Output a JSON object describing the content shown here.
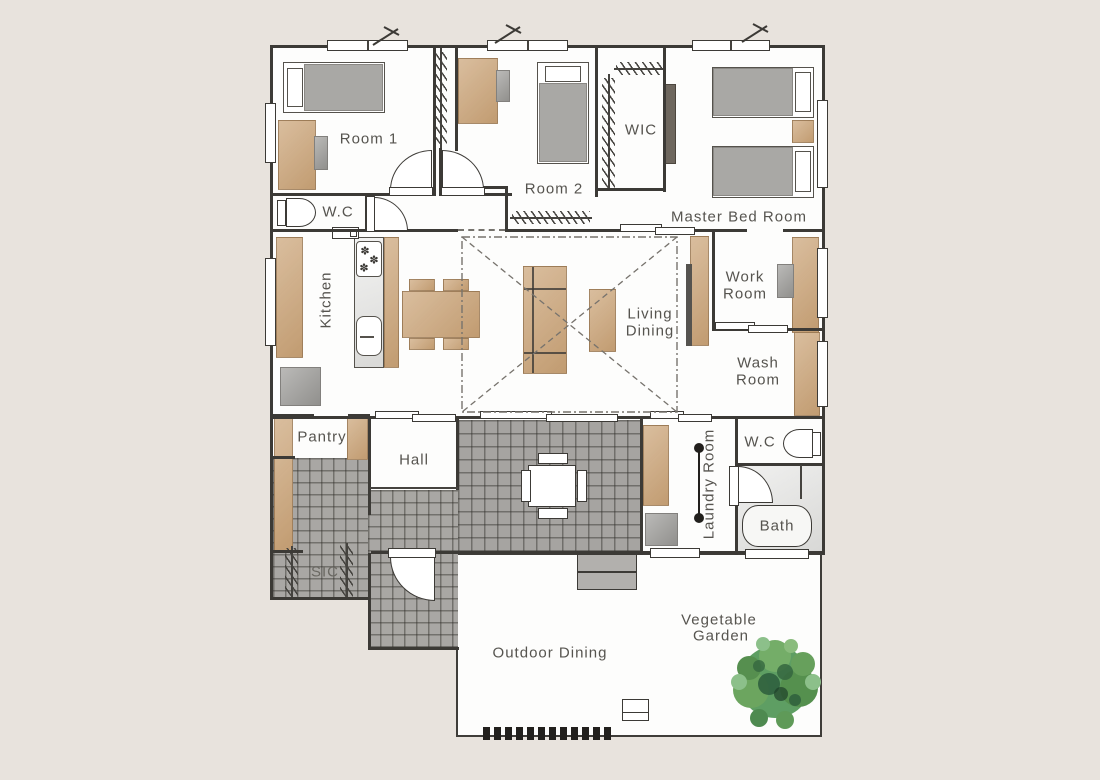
{
  "plan_title": "House floor plan",
  "labels": {
    "room1": "Room 1",
    "room2": "Room 2",
    "wic": "WIC",
    "master_bedroom": "Master Bed Room",
    "wc_upper": "W.C",
    "kitchen": "Kitchen",
    "living_line1": "Living",
    "living_line2": "Dining",
    "work_line1": "Work",
    "work_line2": "Room",
    "wash_line1": "Wash",
    "wash_line2": "Room",
    "pantry": "Pantry",
    "hall": "Hall",
    "wc_lower": "W.C",
    "bath": "Bath",
    "laundry": "Laundry Room",
    "sic": "SIC",
    "outdoor_dining": "Outdoor Dining",
    "garden_line1": "Vegetable",
    "garden_line2": "Garden"
  },
  "icons": {
    "stove_burner_glyph": "✽"
  },
  "colors": {
    "background": "#e8e3dd",
    "floor_white": "#fdfdfc",
    "wall": "#3c3a36",
    "wood_furniture": "#cda87d",
    "gray_furniture": "#a9a8a5",
    "tile_gray": "#a6a4a1",
    "bath_floor": "#e3e3e1",
    "tree_green_mid": "#5e9e63",
    "tree_green_light": "#8cc08a",
    "tree_green_dark": "#2c5c3c",
    "label_text": "#56544f"
  }
}
